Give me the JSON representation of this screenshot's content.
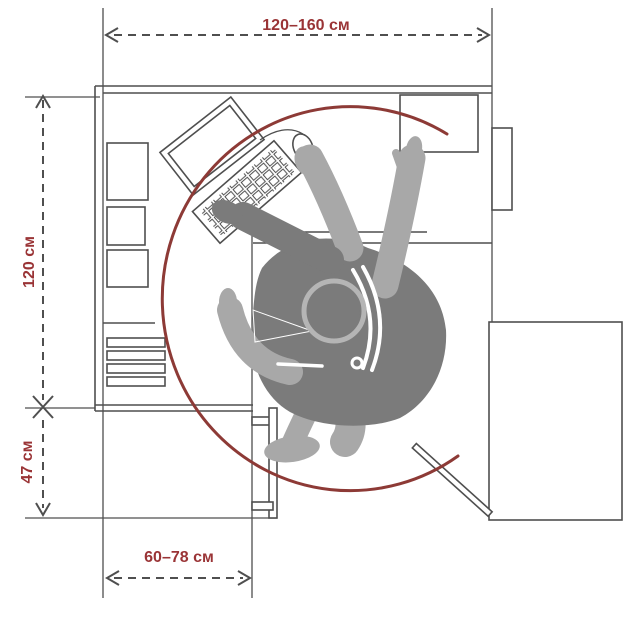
{
  "diagram": {
    "dimensions": {
      "top": {
        "label": "120–160 см"
      },
      "left_upper": {
        "label": "120 см"
      },
      "left_lower": {
        "label": "47 см"
      },
      "bottom": {
        "label": "60–78 см"
      }
    },
    "elements": {
      "reach_arc": "reach-zone-arc",
      "person": "seated-person-top-view",
      "monitor": "monitor-icon",
      "keyboard": "keyboard-icon",
      "mouse": "mouse-icon",
      "desk": "l-shaped-corner-desk",
      "shelves": "side-shelves",
      "drawers": "drawer-slats",
      "keyboard_tray": "pull-out-tray",
      "cabinet": "side-cabinet",
      "door": "open-door-panel"
    }
  },
  "colors": {
    "background": "#ffffff",
    "outline": "#4f4f4f",
    "dimension_text": "#9a3436",
    "reach_arc": "#8d3a36",
    "body_dark": "#7b7b7b",
    "body_light": "#a8a8a8"
  }
}
